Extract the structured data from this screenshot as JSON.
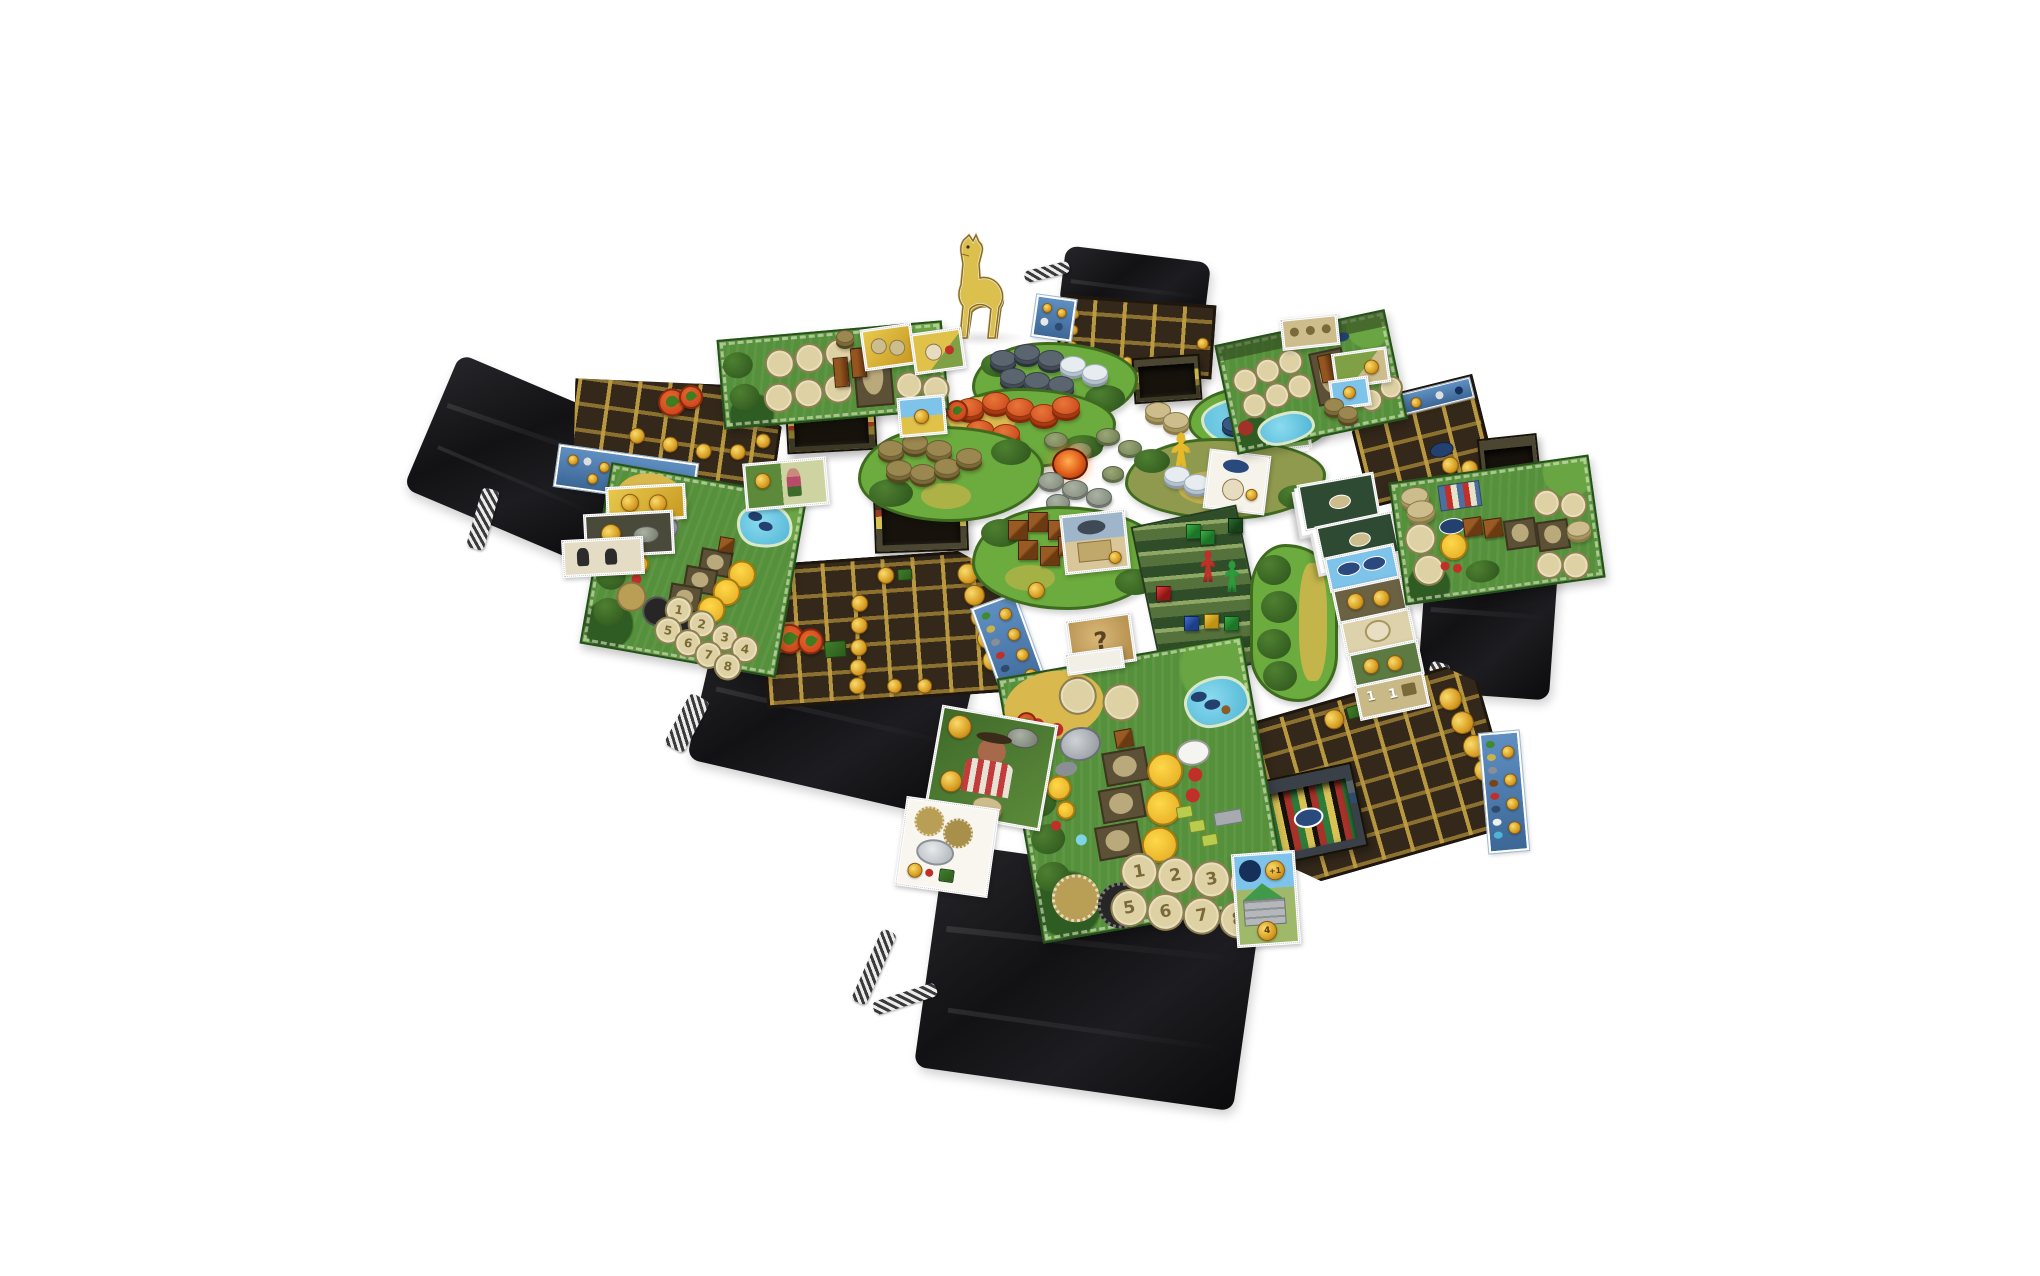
{
  "scene": {
    "description": "Photograph of a farming board game fully set up on a white surface: six green player boards, five dark wooden lattice drying-frame boards, five black cloth drawstring bags, cardboard storage trays, irregular green terrain tiles holding stacks of resource discs (peat, clay, wood, stone, linen), colored meeples and cubes, card stacks and a golden cardboard llama figure.",
    "background_color": "#ffffff"
  },
  "counts": {
    "cloth_bags": 5,
    "player_boards": 6,
    "lattice_boards": 5,
    "storage_trays": 5,
    "terrain_tiles": 7,
    "meeples": 4,
    "llama_figures": 1
  },
  "colors": {
    "bag": "#161619",
    "chain": "#e8e8e8",
    "lattice_board": "#33281a",
    "lattice_grid": "#be9d42",
    "sun_token": "#e7b93c",
    "hop_token": "#d34f1e",
    "board_green": "#55903a",
    "space_tan": "#ded1a3",
    "water_blue": "#5fc3de",
    "score_strip_blue": "#4a7fb5",
    "meeple_blue": "#2a58b0",
    "meeple_yellow": "#e6b92a",
    "meeple_red": "#c03028",
    "meeple_green": "#2c9b3c",
    "clay_disc": "#d85a28",
    "peat_disc": "#5a6570",
    "wood_disc": "#9a8850",
    "linen_disc": "#e6ecef",
    "stone_disc": "#9aa296",
    "cube_brown": "#7a4418",
    "tray_band_gold": "#c8b24a",
    "llama": "#dcc04e"
  },
  "boards": {
    "bottom": {
      "worker_numbers": [
        "1",
        "2",
        "3",
        "4",
        "5",
        "6",
        "7",
        "8"
      ]
    },
    "left": {
      "worker_numbers": [
        "1",
        "2",
        "3",
        "4",
        "5",
        "6",
        "7",
        "8"
      ]
    }
  },
  "tiles": {
    "mystery_mark": "?"
  },
  "cards": {
    "hut": {
      "top_value": "+1",
      "bottom_value": "4"
    },
    "ones": [
      "1",
      "1"
    ]
  }
}
